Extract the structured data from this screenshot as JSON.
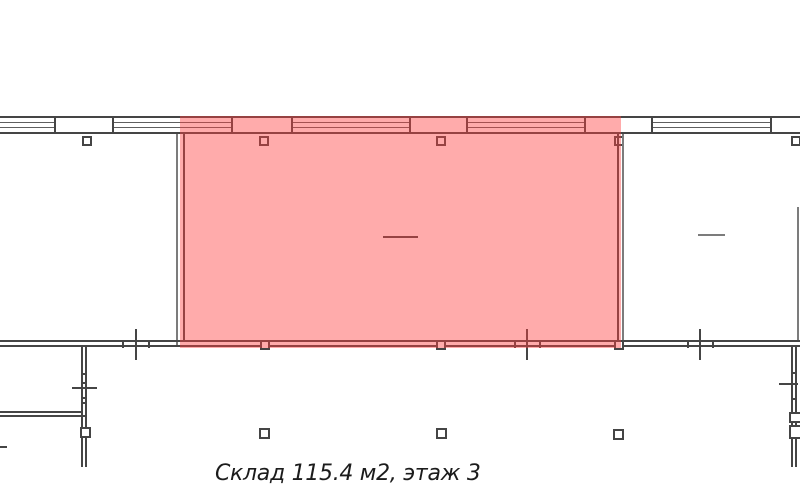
{
  "caption": {
    "text": "Склад 115.4 м2, этаж 3"
  },
  "highlighted_room": {
    "type_label": "Склад",
    "area_label": "115.4 м2",
    "floor_label": "этаж 3"
  },
  "colors": {
    "background": "#ffffff",
    "wall_line": "#454545",
    "secondary_line": "#7c7c7c",
    "glazing_line": "#5f5f5f",
    "room_highlight": "rgba(255,64,64,0.44)",
    "caption_text": "#1c1c1c"
  }
}
